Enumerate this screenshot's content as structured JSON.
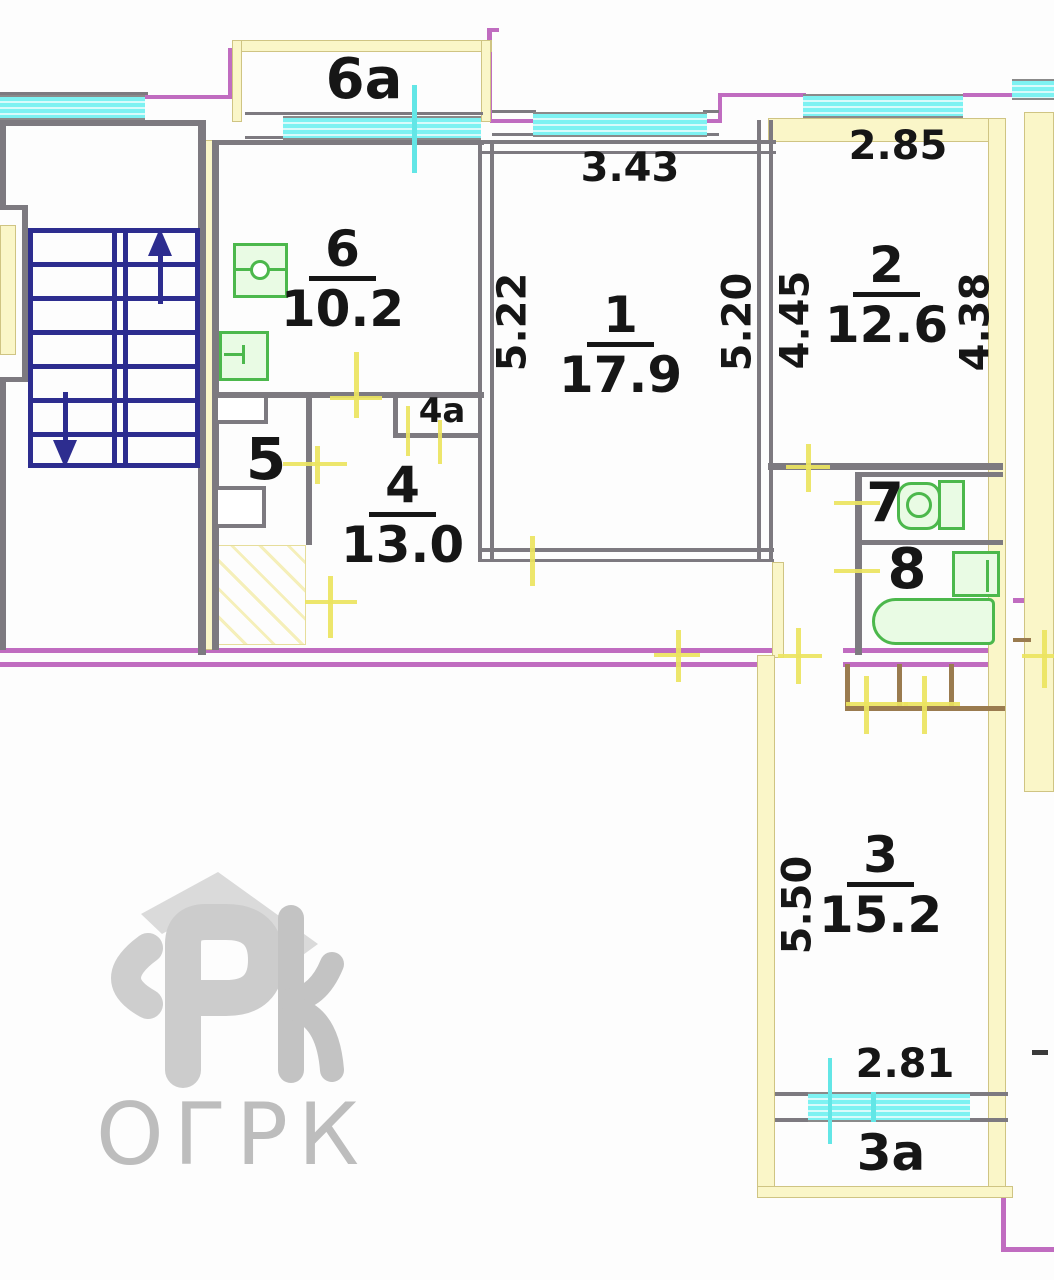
{
  "title": "Apartment floor plan (BTI drawing)",
  "rooms": {
    "r1": {
      "number": "1",
      "area": "17.9"
    },
    "r2": {
      "number": "2",
      "area": "12.6"
    },
    "r3": {
      "number": "3",
      "area": "15.2"
    },
    "r4": {
      "number": "4",
      "area": "13.0"
    },
    "r5": {
      "number": "5"
    },
    "r6": {
      "number": "6",
      "area": "10.2"
    },
    "r7": {
      "number": "7"
    },
    "r8": {
      "number": "8"
    },
    "c4a": {
      "number": "4а"
    },
    "b6a": {
      "number": "6а"
    },
    "b3a": {
      "number": "3а"
    }
  },
  "dims": {
    "room1_width": "3.43",
    "room1_left": "5.22",
    "room1_right": "5.20",
    "room2_width": "2.85",
    "room2_left": "4.45",
    "room2_right": "4.38",
    "room3_height": "5.50",
    "balcony3a_width": "2.81"
  },
  "watermark": {
    "text": "ОГРК"
  },
  "colors": {
    "wall_gray": "#7d7a80",
    "stair_navy": "#2d2d8f",
    "window_cyan": "#7df2f2",
    "wall_yellow": "#faf6c8",
    "outer_magenta": "#c06cc0",
    "fixture_green": "#4cb84c",
    "door_mark_yellow": "#ece45f",
    "closet_brown": "#9a7b4f",
    "text_black": "#161616",
    "watermark_gray": "#bdbdbd"
  }
}
